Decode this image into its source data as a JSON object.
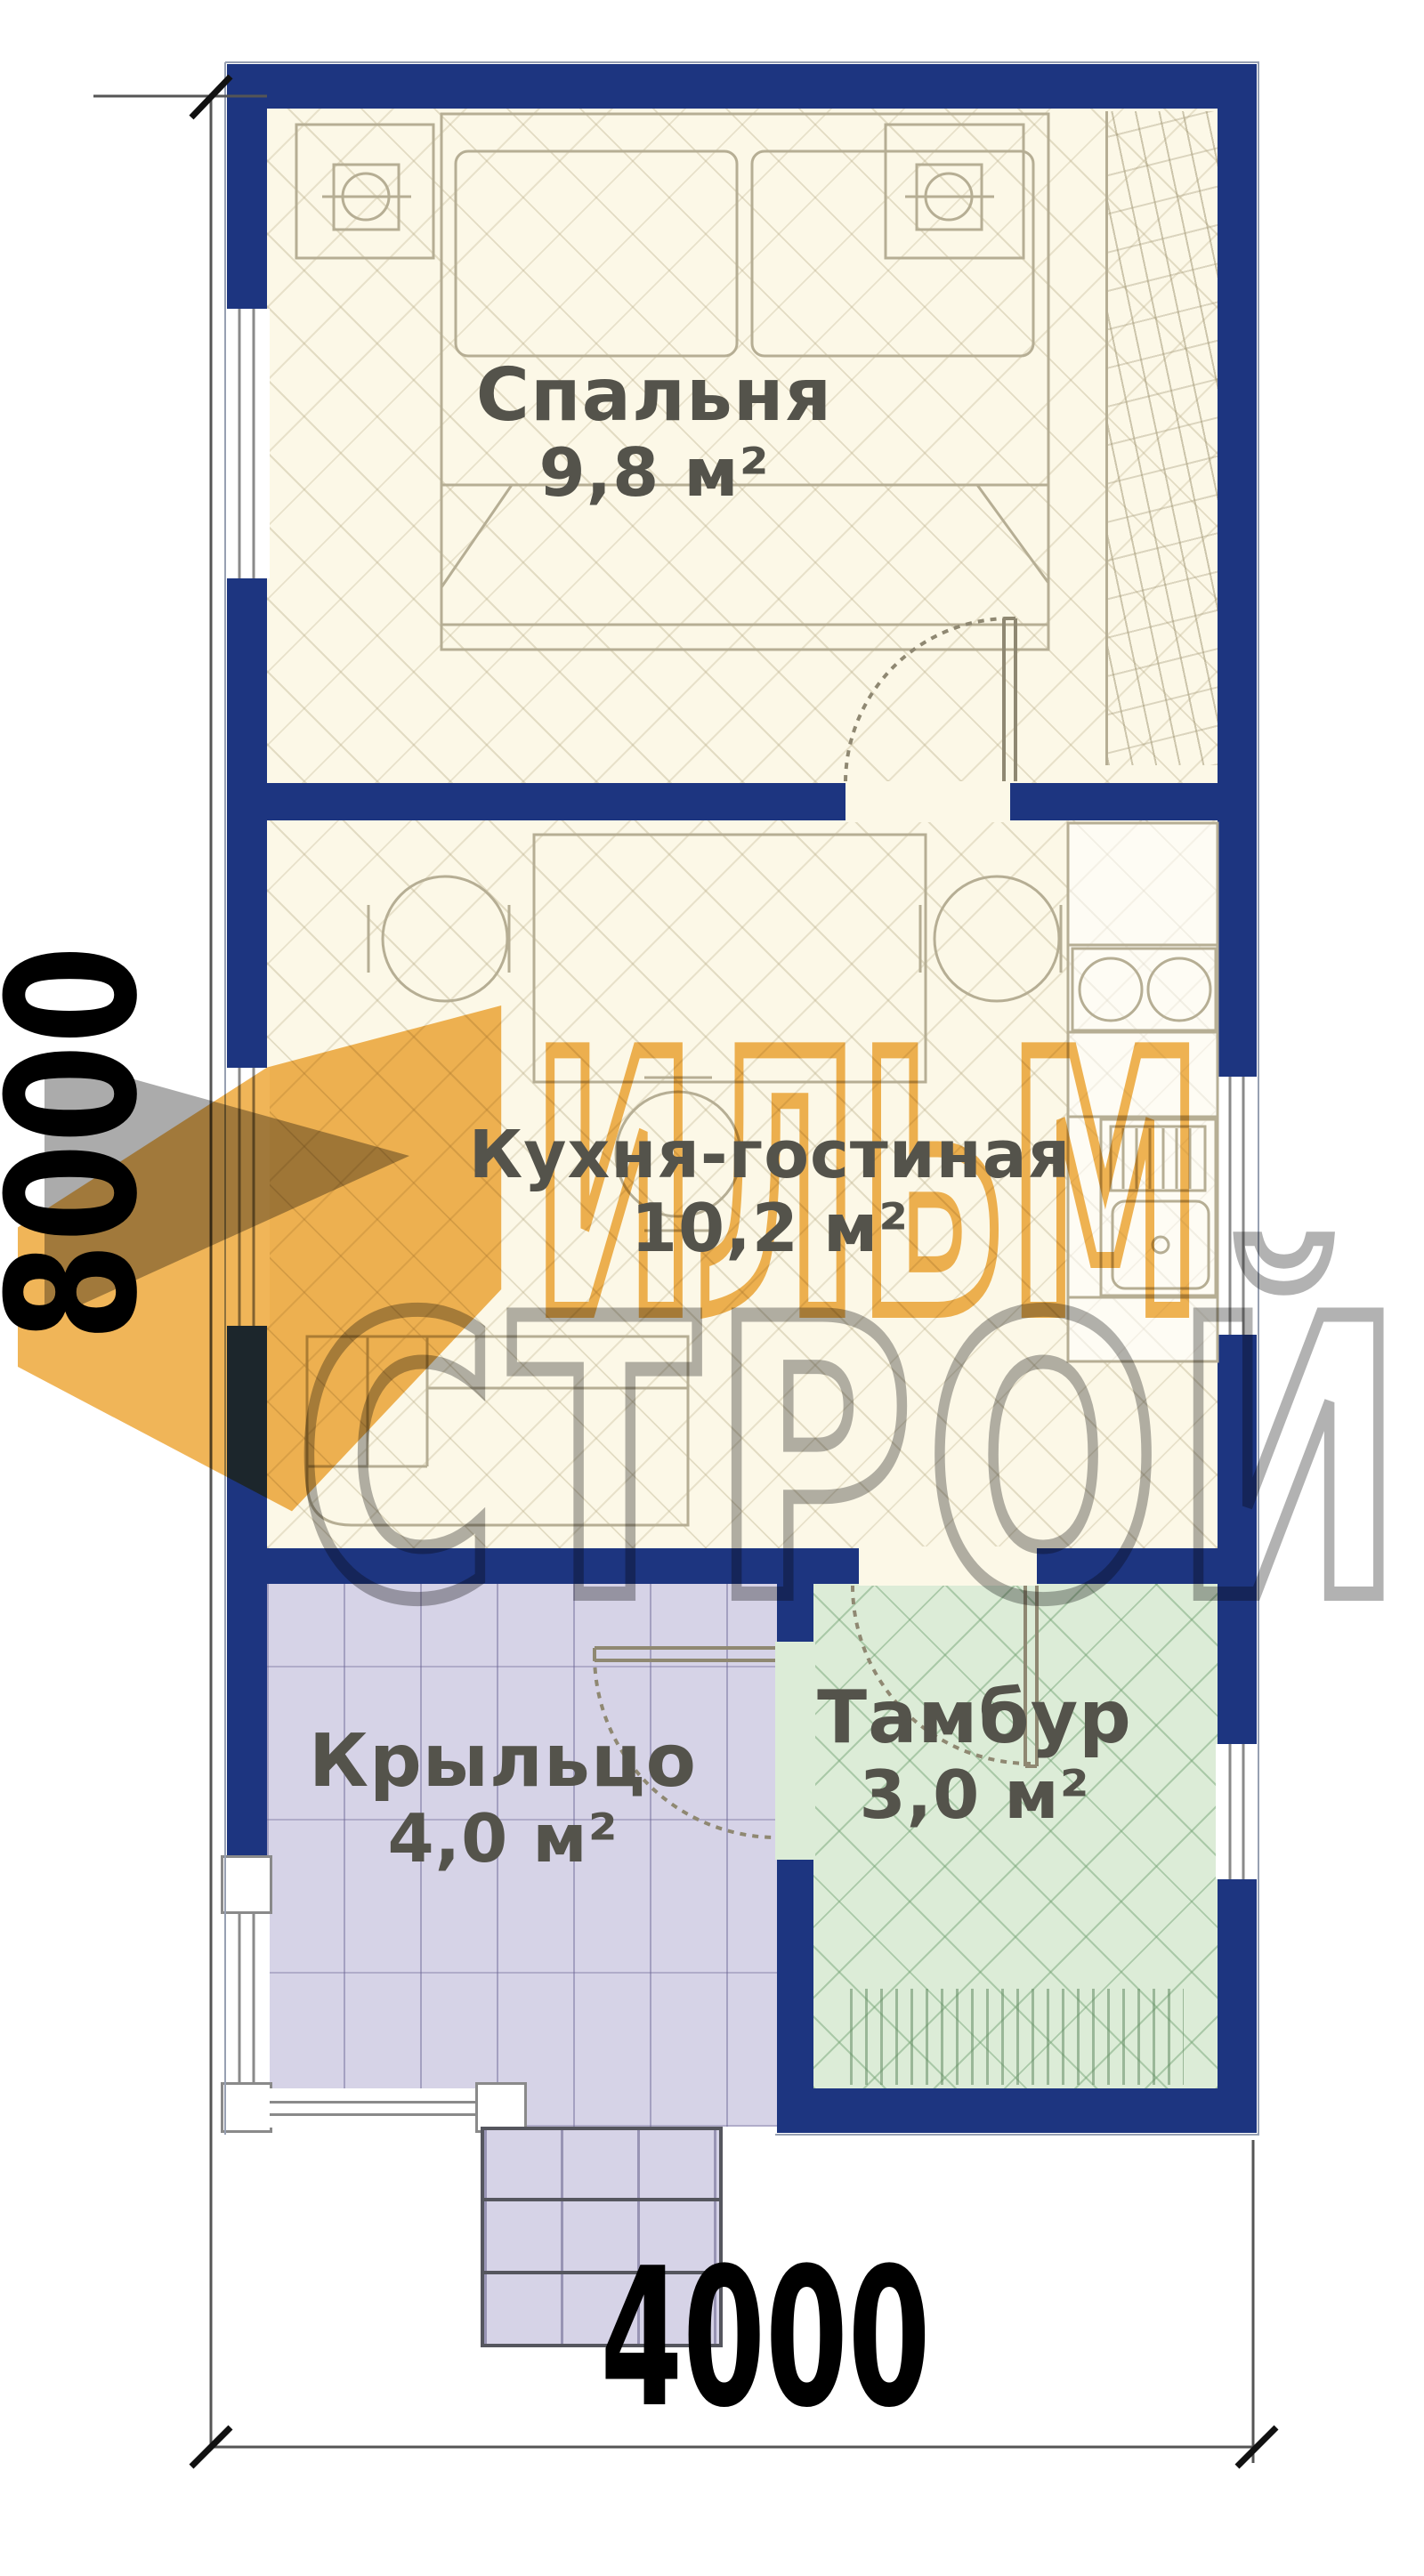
{
  "rooms": [
    {
      "id": "bedroom",
      "name": "Спальня",
      "area": "9,8 м²"
    },
    {
      "id": "kitchen-living",
      "name": "Кухня-гостиная",
      "area": "10,2 м²"
    },
    {
      "id": "porch",
      "name": "Крыльцо",
      "area": "4,0 м²"
    },
    {
      "id": "vestibule",
      "name": "Тамбур",
      "area": "3,0 м²"
    }
  ],
  "dimensions": {
    "overall_height_mm": "8000",
    "overall_width_mm": "4000"
  },
  "watermark": {
    "word1": "ИЛЬМ",
    "word2": "СТРОЙ"
  },
  "colors": {
    "wall_navy": "#1d3580",
    "bedroom_kitchen_floor": "#fcf8e7",
    "porch_floor": "#d6d3e7",
    "vestibule_floor": "#dcecd7",
    "watermark_orange": "#efb456",
    "watermark_gray": "#b2b2b2",
    "label_text": "#54534b"
  }
}
